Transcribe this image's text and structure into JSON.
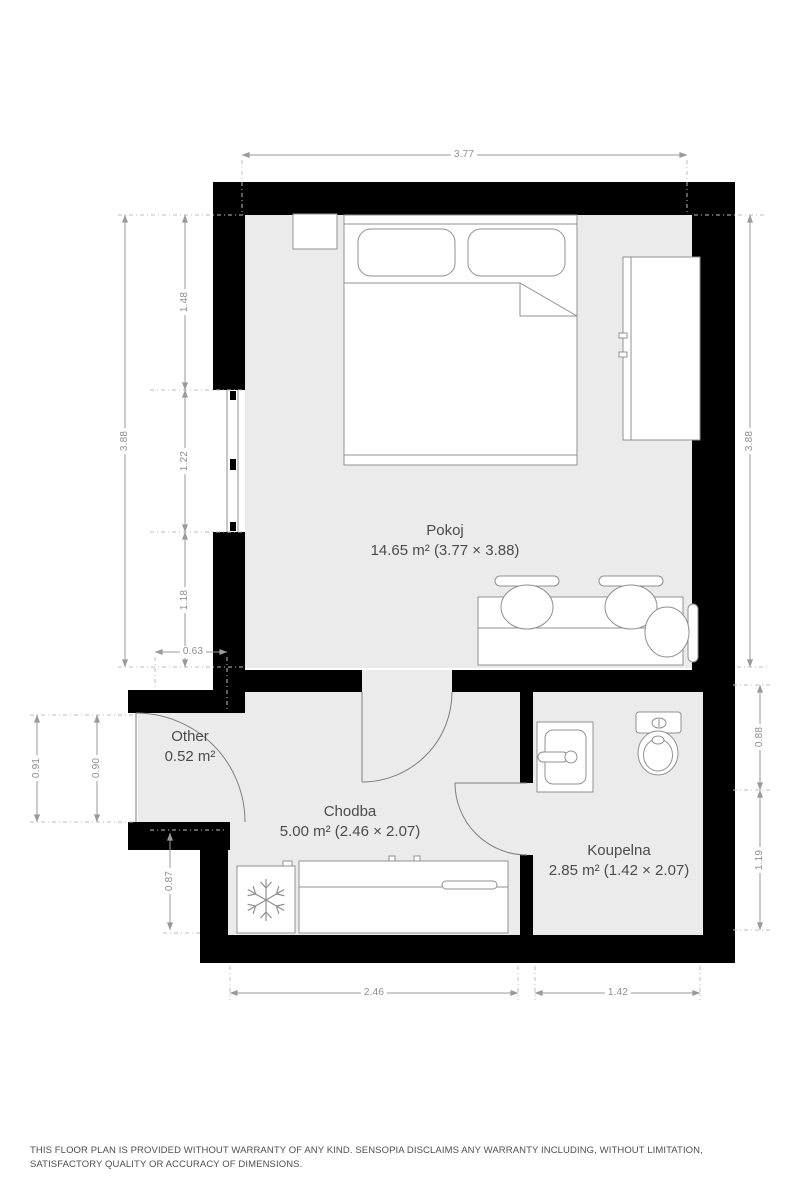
{
  "rooms": {
    "pokoj": {
      "name": "Pokoj",
      "area": "14.65 m² (3.77 × 3.88)"
    },
    "chodba": {
      "name": "Chodba",
      "area": "5.00 m² (2.46 × 2.07)"
    },
    "koupelna": {
      "name": "Koupelna",
      "area": "2.85 m² (1.42 × 2.07)"
    },
    "other": {
      "name": "Other",
      "area": "0.52 m²"
    }
  },
  "dims": {
    "top": "3.77",
    "left": {
      "total": "3.88",
      "upper": "1.48",
      "window": "1.22",
      "lower": "1.18"
    },
    "offset": "0.63",
    "right": {
      "total": "3.88",
      "bath_upper": "0.88",
      "bath_lower": "1.19"
    },
    "entry": {
      "outer": "0.91",
      "inner": "0.90"
    },
    "left_lower": "0.87",
    "bottom": {
      "chodba": "2.46",
      "koupelna": "1.42"
    }
  },
  "furniture": [
    "double-bed",
    "pillows",
    "nightstand",
    "wardrobe",
    "table",
    "chairs",
    "washbasin",
    "toilet",
    "refrigerator",
    "kitchen-counter",
    "window",
    "entrance-door",
    "room-door",
    "bathroom-door"
  ],
  "colors": {
    "wall": "#000000",
    "floor": "#ebebeb",
    "dim_line": "#9a9a9a",
    "furniture_line": "#909090",
    "label_text": "#4b4b4b"
  },
  "disclaimer": "THIS FLOOR PLAN IS PROVIDED WITHOUT WARRANTY OF ANY KIND. SENSOPIA DISCLAIMS ANY WARRANTY INCLUDING, WITHOUT LIMITATION, SATISFACTORY QUALITY OR ACCURACY OF DIMENSIONS."
}
